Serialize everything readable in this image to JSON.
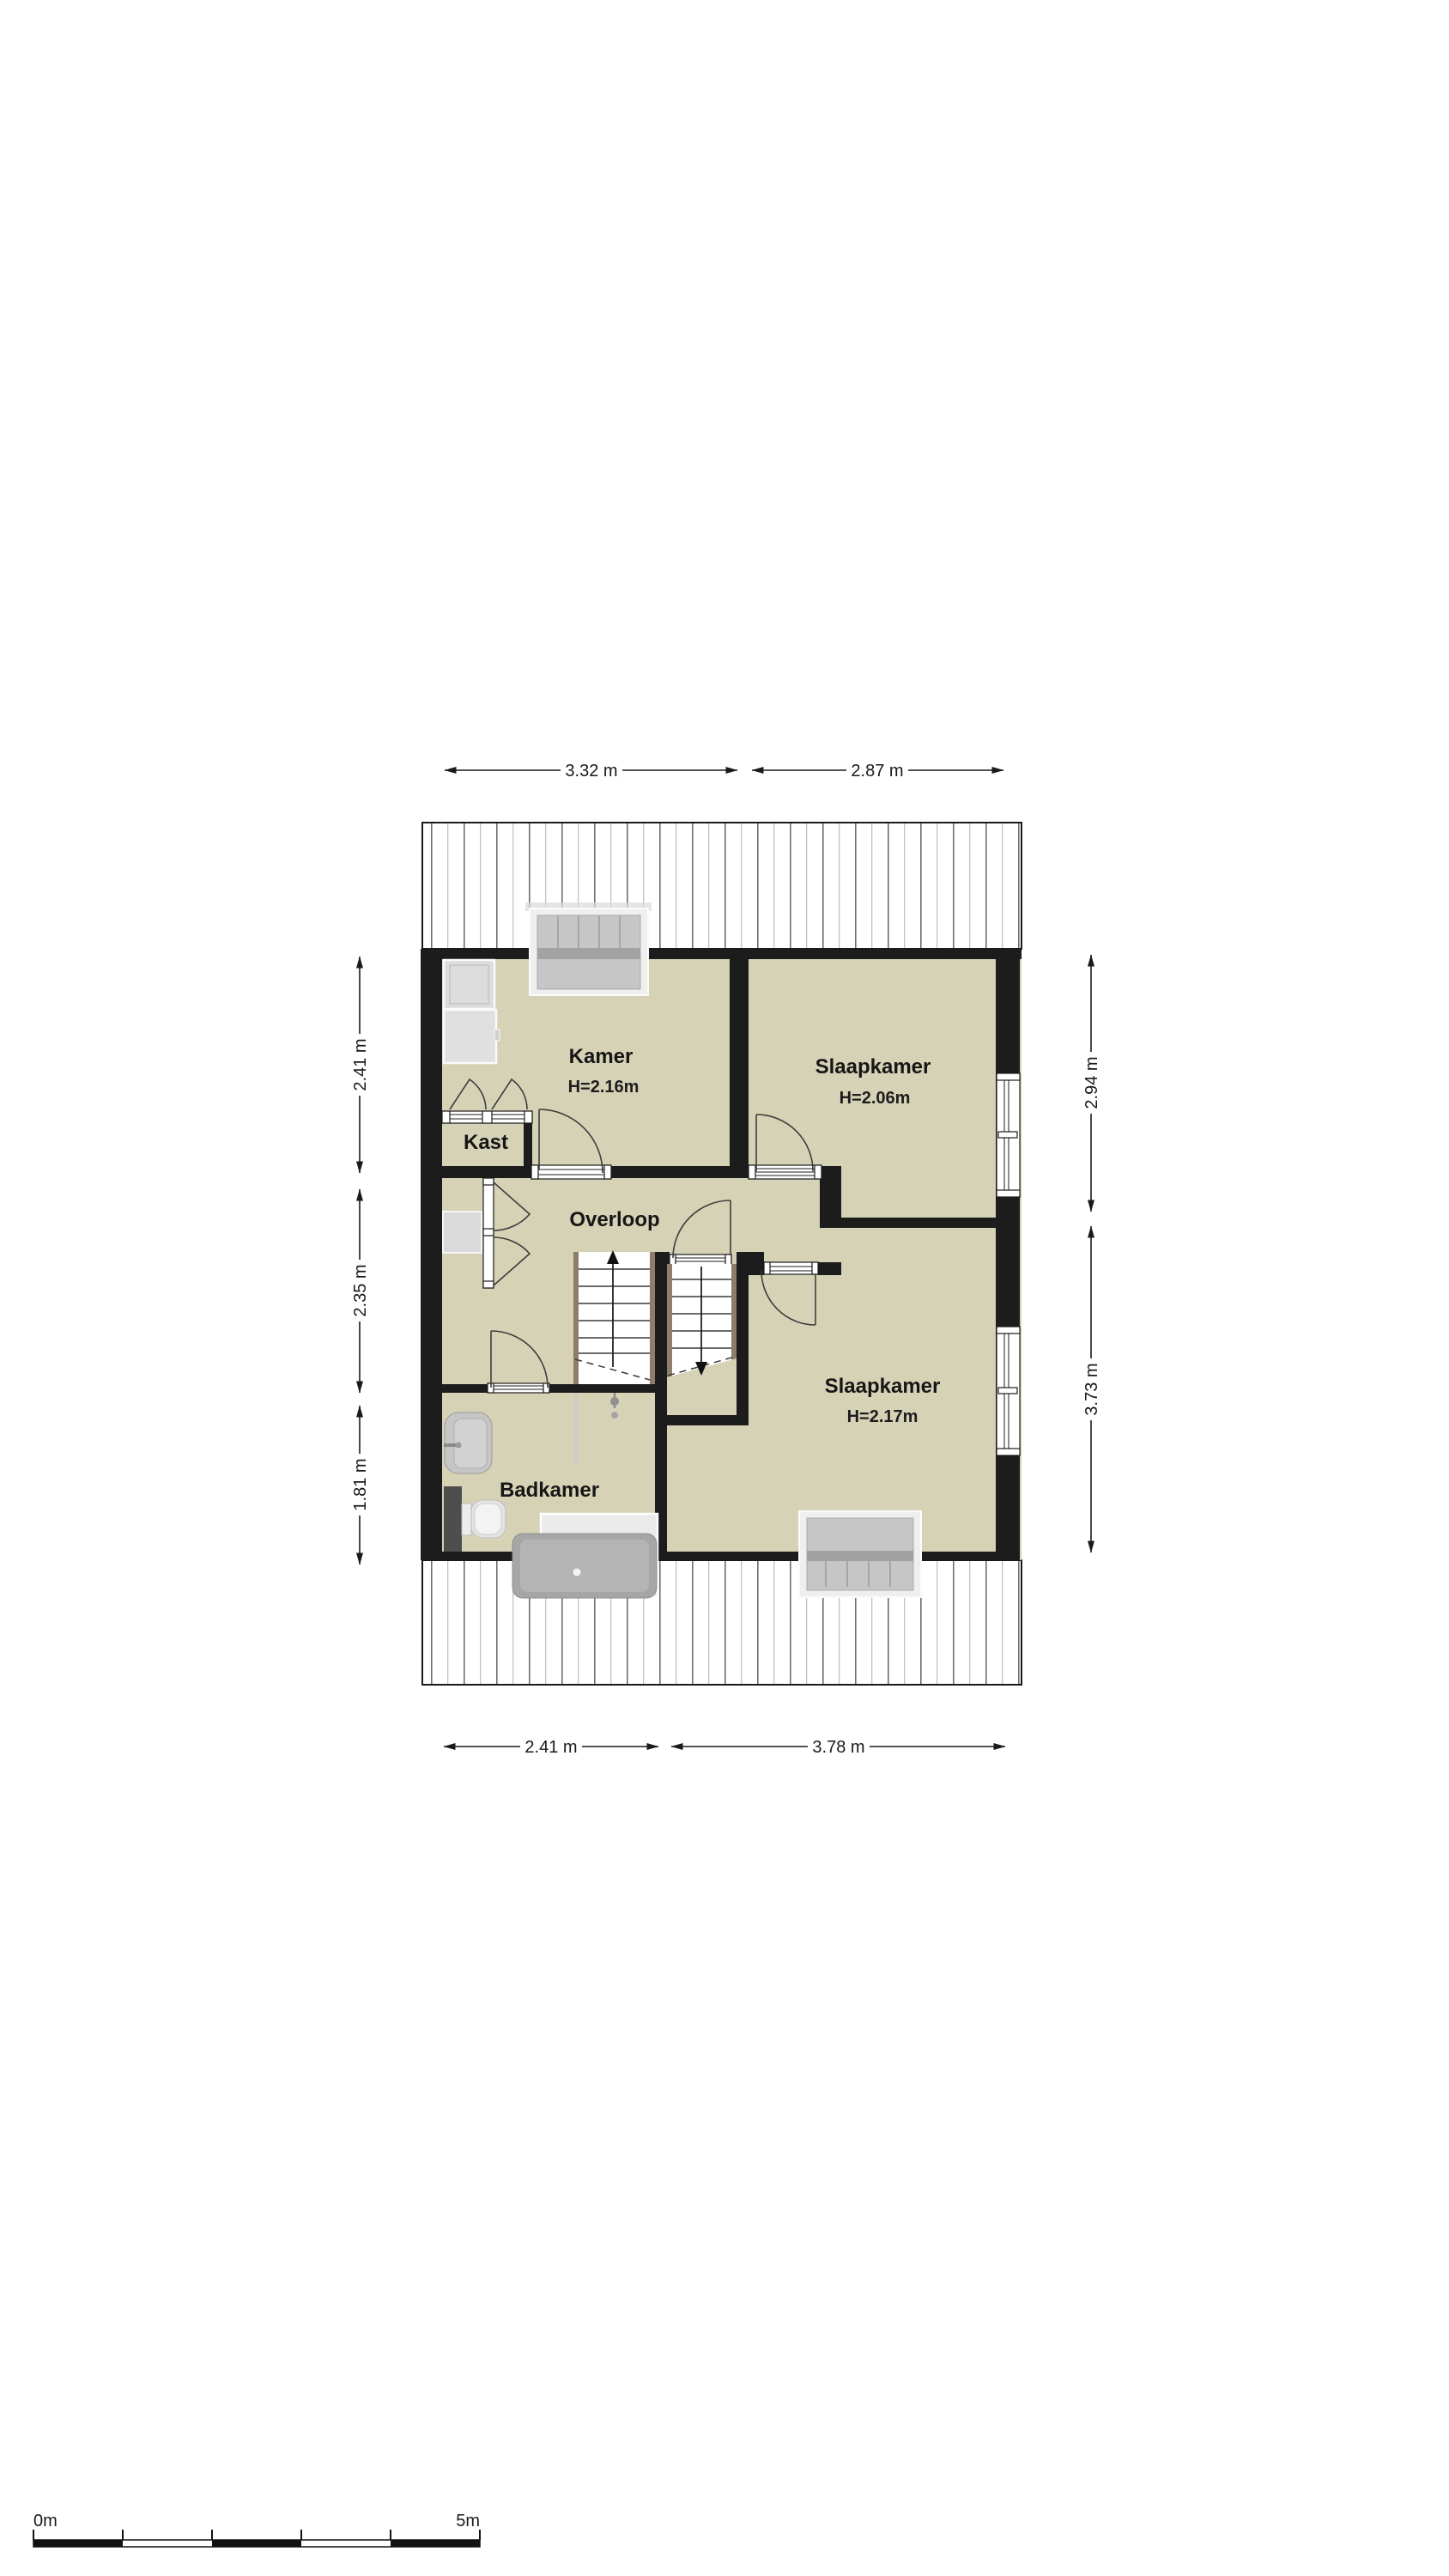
{
  "floor_plan": {
    "rooms": {
      "kamer": {
        "name": "Kamer",
        "height": "H=2.16m"
      },
      "slaapkamer_boven": {
        "name": "Slaapkamer",
        "height": "H=2.06m"
      },
      "kast": {
        "name": "Kast"
      },
      "overloop": {
        "name": "Overloop"
      },
      "badkamer": {
        "name": "Badkamer"
      },
      "slaapkamer_onder": {
        "name": "Slaapkamer",
        "height": "H=2.17m"
      }
    },
    "dimensions": {
      "top": [
        "3.32 m",
        "2.87 m"
      ],
      "bottom": [
        "2.41 m",
        "3.78 m"
      ],
      "left": [
        "2.41 m",
        "2.35 m",
        "1.81 m"
      ],
      "right": [
        "2.94 m",
        "3.73 m"
      ]
    },
    "scale_bar": {
      "start": "0m",
      "end": "5m"
    },
    "colors": {
      "floor": "#d6d2b6",
      "wall": "#1c1c1c",
      "roof_hatch": "#6f6f6f"
    }
  }
}
